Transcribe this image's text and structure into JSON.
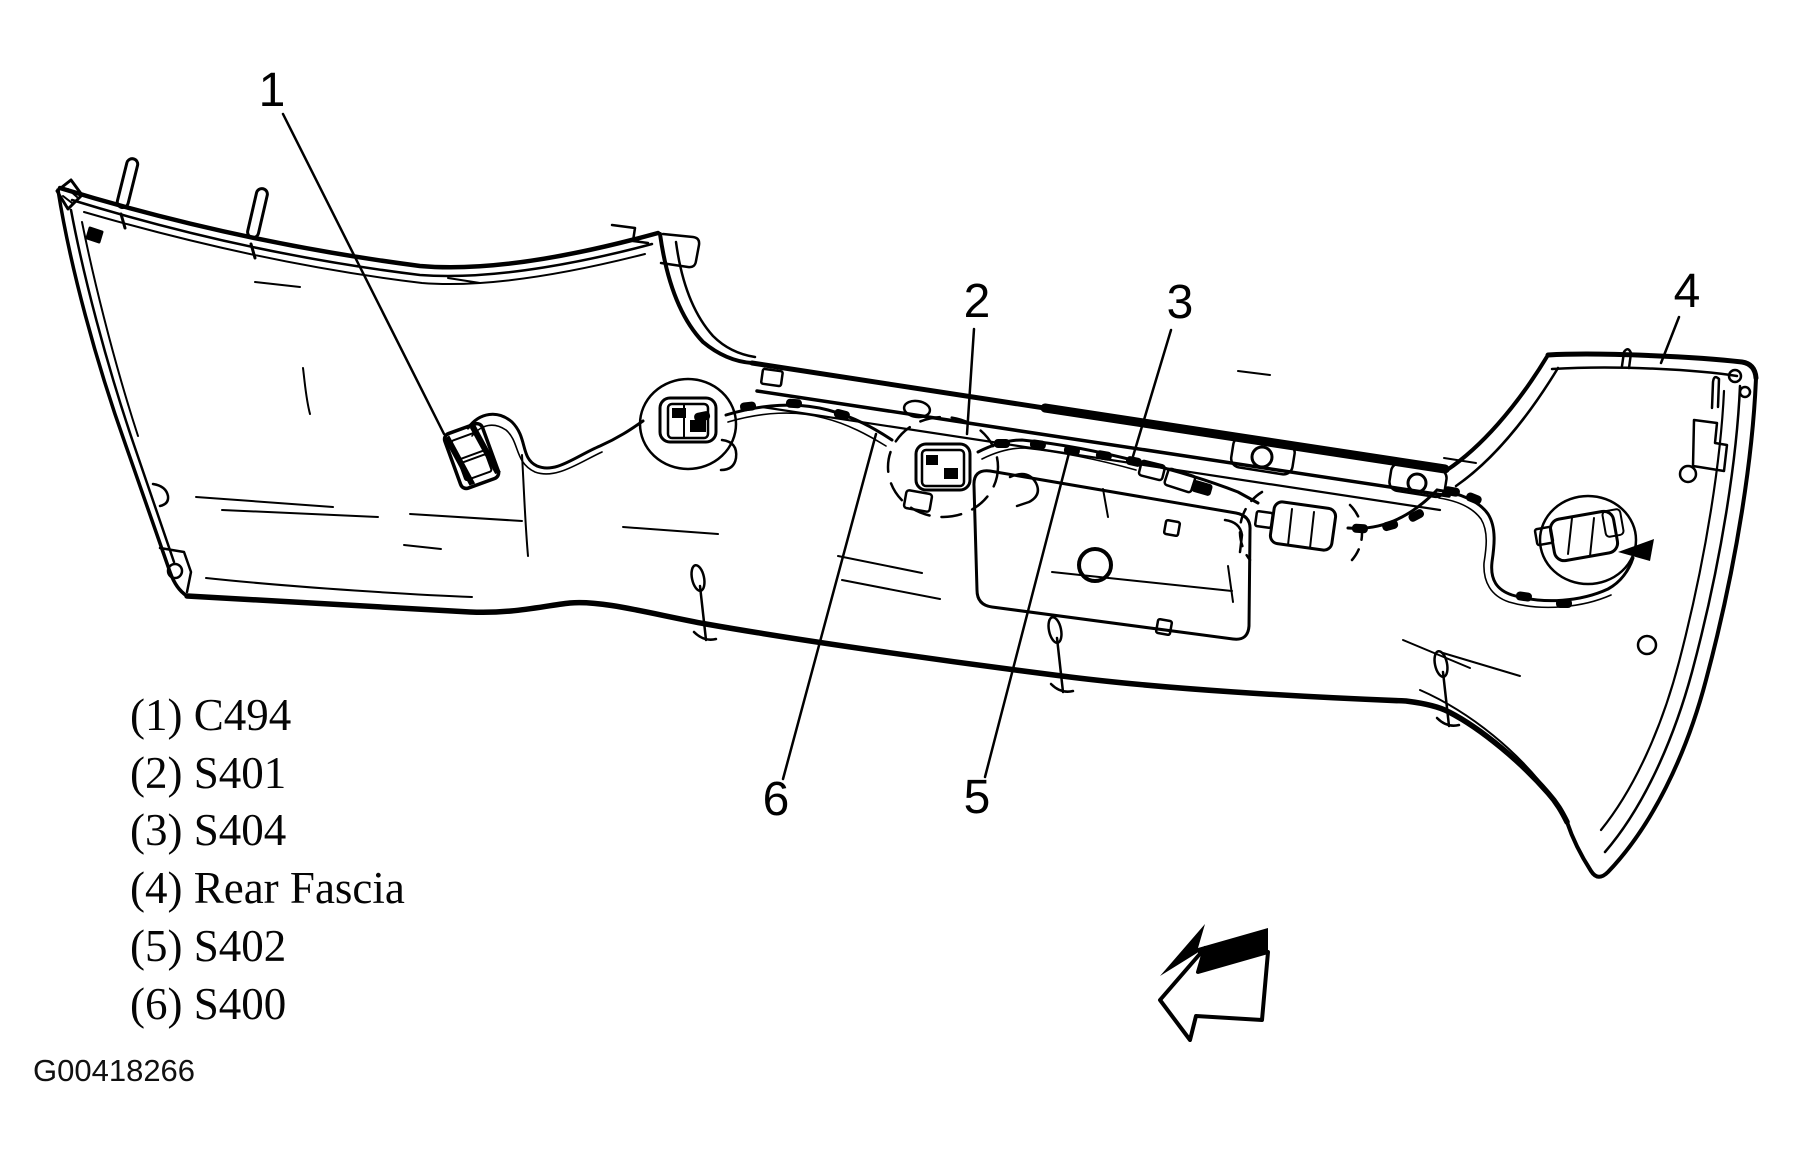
{
  "page": {
    "background_color": "#ffffff",
    "ink_color": "#000000",
    "kind": "technical line illustration"
  },
  "figure": {
    "id": "G00418266",
    "subject": "Rear bumper fascia with wiring harness routing"
  },
  "callouts": [
    {
      "number": "1",
      "label": "C494"
    },
    {
      "number": "2",
      "label": "S401"
    },
    {
      "number": "3",
      "label": "S404"
    },
    {
      "number": "4",
      "label": "Rear Fascia"
    },
    {
      "number": "5",
      "label": "S402"
    },
    {
      "number": "6",
      "label": "S400"
    }
  ],
  "legend": {
    "items": [
      {
        "text": "(1) C494"
      },
      {
        "text": "(2) S401"
      },
      {
        "text": "(3) S404"
      },
      {
        "text": "(4) Rear Fascia"
      },
      {
        "text": "(5) S402"
      },
      {
        "text": "(6) S400"
      }
    ]
  },
  "icons": {
    "direction_arrow": "3d-block-arrow-pointing-lower-left"
  }
}
